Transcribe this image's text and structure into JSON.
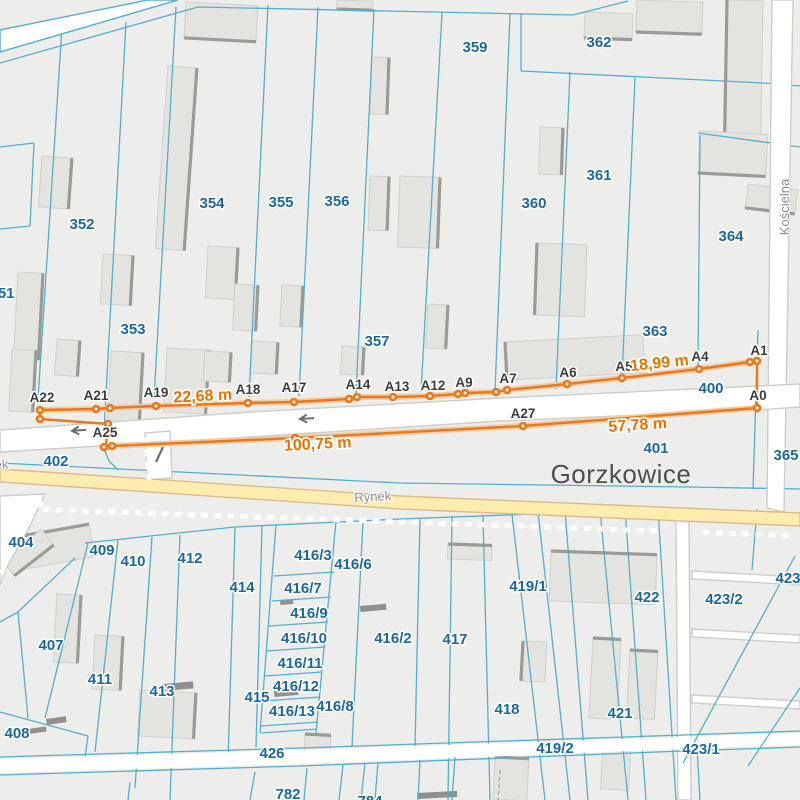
{
  "map": {
    "title": "Cadastral map with survey measurement line, Gorzkowice",
    "town_label": {
      "text": "Gorzkowice",
      "x": 621,
      "y": 483
    },
    "street_labels": [
      {
        "text": "Rynek",
        "x": 373,
        "y": 501,
        "rot": -3,
        "anchor": "middle"
      },
      {
        "text": "Rynek",
        "x": -28,
        "y": 471,
        "rot": -4,
        "anchor": "start"
      },
      {
        "text": "Kościelna",
        "x": 789,
        "y": 207,
        "rot": -90,
        "anchor": "middle"
      }
    ],
    "colors": {
      "land": "#ededeb",
      "parcelLine": "#54aecd",
      "parcelLabel": "#1b679f",
      "building": "#e3e3e0",
      "buildingStroke": "#cfcfcc",
      "buildingShadow": "#9a9a97",
      "road": "#ffffff",
      "roadCasing": "#cdcdca",
      "yellowRoad": "#fcecae",
      "yellowCasing": "#dfba8e",
      "survey": "#e8791d",
      "surveyHalo": "#f0cda6",
      "distance": "#e87200",
      "pointLabel": "#3c3c3c",
      "town": "#4f4f4f",
      "street": "#8e8e8e",
      "arrow": "#6e6e6e",
      "dash": "#ffffff",
      "bar": "#8f8f8c"
    },
    "survey": {
      "points": [
        {
          "id": "A22",
          "x": 40,
          "y": 410,
          "label_x": 42,
          "label_y": 402
        },
        {
          "id": "A21",
          "x": 96,
          "y": 409,
          "label_x": 96,
          "label_y": 400
        },
        {
          "id": "A19",
          "x": 156,
          "y": 406,
          "label_x": 156,
          "label_y": 397
        },
        {
          "id": "A18",
          "x": 248,
          "y": 403,
          "label_x": 248,
          "label_y": 394
        },
        {
          "id": "A17",
          "x": 294,
          "y": 402,
          "label_x": 294,
          "label_y": 392
        },
        {
          "id": "A14",
          "x": 349,
          "y": 399,
          "label_x": 358,
          "label_y": 389
        },
        {
          "id": "A13",
          "x": 393,
          "y": 397,
          "label_x": 397,
          "label_y": 391
        },
        {
          "id": "A12",
          "x": 430,
          "y": 396,
          "label_x": 433,
          "label_y": 390
        },
        {
          "id": "A9",
          "x": 458,
          "y": 394,
          "label_x": 464,
          "label_y": 387
        },
        {
          "id": "A7",
          "x": 496,
          "y": 392,
          "label_x": 508,
          "label_y": 383
        },
        {
          "id": "A6",
          "x": 567,
          "y": 384,
          "label_x": 568,
          "label_y": 377
        },
        {
          "id": "A5",
          "x": 622,
          "y": 378,
          "label_x": 624,
          "label_y": 371
        },
        {
          "id": "A4",
          "x": 699,
          "y": 369,
          "label_x": 700,
          "label_y": 361
        },
        {
          "id": "A1",
          "x": 757,
          "y": 361,
          "label_x": 759,
          "label_y": 355
        },
        {
          "id": "A0",
          "x": 757,
          "y": 408,
          "label_x": 758,
          "label_y": 400
        },
        {
          "id": "A27",
          "x": 523,
          "y": 426,
          "label_x": 523,
          "label_y": 418
        },
        {
          "id": "A25",
          "x": 108,
          "y": 424,
          "label_x": 105,
          "label_y": 437
        }
      ],
      "extra_points": [
        [
          40,
          419
        ],
        [
          110,
          408
        ],
        [
          357,
          397
        ],
        [
          465,
          393
        ],
        [
          507,
          390
        ],
        [
          750,
          362
        ],
        [
          104,
          447
        ],
        [
          112,
          446
        ],
        [
          295,
          438
        ]
      ],
      "polylines": {
        "upper": "40,410 96,409 110,408 156,406 248,403 294,402 349,399 357,397 393,397 430,396 458,394 465,393 496,392 507,390 567,384 622,378 699,369 750,362 757,361",
        "a22_tie": "40,410 40,419",
        "a25_link": "40,419 108,424 106,445",
        "lower": "104,447 112,446 295,438 523,426 757,408",
        "a1_a0": "757,361 757,408"
      },
      "distance_labels": [
        {
          "text": "22,68 m",
          "x": 203,
          "y": 401,
          "rot": -3
        },
        {
          "text": "18,99 m",
          "x": 660,
          "y": 368,
          "rot": -6
        },
        {
          "text": "100,75 m",
          "x": 318,
          "y": 449,
          "rot": -3
        },
        {
          "text": "57,78 m",
          "x": 638,
          "y": 430,
          "rot": -4
        }
      ]
    },
    "parcel_labels": [
      {
        "text": "359",
        "x": 475,
        "y": 52
      },
      {
        "text": "362",
        "x": 599,
        "y": 47
      },
      {
        "text": "361",
        "x": 599,
        "y": 180
      },
      {
        "text": "360",
        "x": 534,
        "y": 208
      },
      {
        "text": "364",
        "x": 731,
        "y": 241
      },
      {
        "text": "354",
        "x": 212,
        "y": 208
      },
      {
        "text": "355",
        "x": 281,
        "y": 207
      },
      {
        "text": "356",
        "x": 337,
        "y": 206
      },
      {
        "text": "352",
        "x": 82,
        "y": 229
      },
      {
        "text": "353",
        "x": 133,
        "y": 334
      },
      {
        "text": "351",
        "x": 2,
        "y": 298
      },
      {
        "text": "357",
        "x": 377,
        "y": 346
      },
      {
        "text": "363",
        "x": 655,
        "y": 336
      },
      {
        "text": "400",
        "x": 711,
        "y": 393
      },
      {
        "text": "401",
        "x": 656,
        "y": 453
      },
      {
        "text": "402",
        "x": 56,
        "y": 466
      },
      {
        "text": "365",
        "x": 786,
        "y": 460
      },
      {
        "text": "404",
        "x": 21,
        "y": 547
      },
      {
        "text": "409",
        "x": 102,
        "y": 555
      },
      {
        "text": "410",
        "x": 133,
        "y": 566
      },
      {
        "text": "412",
        "x": 190,
        "y": 563
      },
      {
        "text": "414",
        "x": 242,
        "y": 592
      },
      {
        "text": "416/3",
        "x": 313,
        "y": 560
      },
      {
        "text": "416/6",
        "x": 353,
        "y": 569
      },
      {
        "text": "416/7",
        "x": 303,
        "y": 593
      },
      {
        "text": "416/9",
        "x": 309,
        "y": 618
      },
      {
        "text": "416/10",
        "x": 304,
        "y": 643
      },
      {
        "text": "416/11",
        "x": 300,
        "y": 668
      },
      {
        "text": "416/12",
        "x": 296,
        "y": 691
      },
      {
        "text": "416/13",
        "x": 292,
        "y": 716
      },
      {
        "text": "416/8",
        "x": 335,
        "y": 711
      },
      {
        "text": "416/2",
        "x": 393,
        "y": 643
      },
      {
        "text": "417",
        "x": 455,
        "y": 644
      },
      {
        "text": "419/1",
        "x": 528,
        "y": 591
      },
      {
        "text": "422",
        "x": 647,
        "y": 602
      },
      {
        "text": "423/2",
        "x": 724,
        "y": 604
      },
      {
        "text": "423",
        "x": 788,
        "y": 583
      },
      {
        "text": "421",
        "x": 620,
        "y": 718
      },
      {
        "text": "418",
        "x": 507,
        "y": 714
      },
      {
        "text": "419/2",
        "x": 555,
        "y": 753
      },
      {
        "text": "423/1",
        "x": 701,
        "y": 754
      },
      {
        "text": "407",
        "x": 51,
        "y": 650
      },
      {
        "text": "411",
        "x": 100,
        "y": 684
      },
      {
        "text": "413",
        "x": 162,
        "y": 696
      },
      {
        "text": "415",
        "x": 257,
        "y": 702
      },
      {
        "text": "408",
        "x": 17,
        "y": 738
      },
      {
        "text": "426",
        "x": 272,
        "y": 758
      },
      {
        "text": "782",
        "x": 288,
        "y": 799
      },
      {
        "text": "784",
        "x": 370,
        "y": 806
      }
    ],
    "geometry": {
      "parcel_lines": [
        "0,63 198,7",
        "198,7 573,15",
        "573,15 628,1",
        "521,14 521,71",
        "521,71 763,83 800,86",
        "698,133 800,147",
        "0,147 34,143",
        "34,143 30,226",
        "0,229 30,226",
        "62,27 38,399",
        "126,22 104,431",
        "176,7 154,399",
        "268,5 249,397",
        "318,7 299,396",
        "374,9 356,394",
        "442,13 421,392",
        "510,14 495,391",
        "570,72 556,389",
        "635,78 622,378",
        "700,135 698,368",
        "0,463 400,483 690,487 800,489",
        "85,543 235,527 400,519 560,513 683,508",
        "88,543 45,718",
        "75,558 18,612 0,622",
        "18,612 28,718",
        "118,540 95,752",
        "152,537 135,788",
        "180,535 170,800",
        "235,528 228,762",
        "262,526 256,747",
        "276,525 260,733",
        "336,521 316,733",
        "274,576 334,572",
        "272,601 331,597",
        "269,626 328,622",
        "267,651 325,647",
        "265,676 322,672",
        "263,701 320,697",
        "261,726 318,722",
        "261,733 317,729",
        "363,520 352,747",
        "420,518 415,747",
        "452,516 448,800",
        "483,515 490,800",
        "512,514 545,800",
        "538,512 570,800",
        "565,511 588,800",
        "600,510 628,800",
        "625,509 646,800",
        "658,509 676,800",
        "757,509 752,570",
        "0,712 88,736",
        "88,736 85,757"
      ],
      "parcel_lines_over": [
        "758,330 753,489",
        "104,449 109,461 118,470",
        "0,757 300,748 683,735 800,731",
        "0,775 300,766 683,751 800,747",
        "795,556 683,763",
        "800,688 748,766",
        "255,772 250,800",
        "307,768 304,800",
        "343,765 339,800",
        "365,763 361,800",
        "378,762 375,800",
        "420,760 418,800",
        "455,757 452,800",
        "130,782 128,800",
        "697,748 700,800"
      ],
      "roads": [
        {
          "name": "road-topleft-diagonal",
          "pts": "0,30 148,0 178,0 0,52",
          "fill": "road",
          "stroke": "parcelLine"
        },
        {
          "name": "road-koscielna",
          "pts": "772,0 793,0 784,512 767,508",
          "fill": "road",
          "stroke": "roadCasing"
        },
        {
          "name": "road-mid-street",
          "pts": "0,430 250,412 500,398 757,386 800,384 800,407 757,410 500,421 250,437 0,452",
          "fill": "road",
          "stroke": "roadCasing"
        },
        {
          "name": "road-connector-west",
          "pts": "145,433 170,431 172,478 147,480",
          "fill": "road",
          "stroke": "roadCasing"
        },
        {
          "name": "road-left-curve",
          "pts": "0,496 45,494 28,530 8,565 0,585",
          "fill": "road",
          "stroke": "roadCasing"
        },
        {
          "name": "road-rynek",
          "pts": "0,469 120,477 400,496 683,508 800,513 800,526 683,521 400,509 120,490 0,482",
          "fill": "yellowRoad",
          "stroke": "yellowCasing"
        },
        {
          "name": "road-connector-south",
          "pts": "676,521 689,522 691,800 678,800",
          "fill": "road",
          "stroke": "roadCasing"
        },
        {
          "name": "road-bottom-426",
          "pts": "0,759 300,750 683,737 800,733 800,745 683,749 300,764 0,773",
          "fill": "road",
          "stroke": "none"
        },
        {
          "name": "track-east-1",
          "pts": "692,571 800,577 800,585 692,579",
          "fill": "road",
          "stroke": "roadCasing"
        },
        {
          "name": "track-east-2",
          "pts": "692,629 800,635 800,643 692,637",
          "fill": "road",
          "stroke": "roadCasing"
        },
        {
          "name": "track-east-3",
          "pts": "692,695 800,701 800,709 692,703",
          "fill": "road",
          "stroke": "roadCasing"
        }
      ],
      "buildings": [
        [
          186,
          2,
          72,
          36,
          3,
          "b"
        ],
        [
          337,
          0,
          36,
          9,
          2,
          "b"
        ],
        [
          585,
          12,
          48,
          26,
          2,
          "b"
        ],
        [
          637,
          0,
          66,
          32,
          2,
          "b"
        ],
        [
          727,
          0,
          36,
          135,
          1,
          "l"
        ],
        [
          700,
          131,
          68,
          42,
          3,
          "b"
        ],
        [
          748,
          184,
          50,
          24,
          7,
          "b"
        ],
        [
          540,
          127,
          23,
          47,
          2,
          "r"
        ],
        [
          400,
          176,
          40,
          71,
          2,
          "r"
        ],
        [
          428,
          304,
          20,
          44,
          3,
          "r"
        ],
        [
          168,
          66,
          29,
          183,
          4,
          "r"
        ],
        [
          42,
          156,
          30,
          51,
          4,
          "r"
        ],
        [
          18,
          272,
          25,
          87,
          3,
          "r"
        ],
        [
          103,
          254,
          30,
          50,
          3,
          "r"
        ],
        [
          208,
          246,
          30,
          52,
          3,
          "r"
        ],
        [
          235,
          284,
          23,
          46,
          3,
          "r"
        ],
        [
          282,
          285,
          21,
          41,
          3,
          "r"
        ],
        [
          370,
          176,
          19,
          54,
          2,
          "r"
        ],
        [
          372,
          57,
          17,
          57,
          2,
          "r"
        ],
        [
          12,
          349,
          24,
          62,
          3,
          "r"
        ],
        [
          57,
          339,
          23,
          36,
          4,
          "r"
        ],
        [
          111,
          351,
          32,
          74,
          3,
          "r"
        ],
        [
          167,
          348,
          42,
          64,
          3,
          "r"
        ],
        [
          205,
          351,
          26,
          30,
          3,
          "r"
        ],
        [
          252,
          341,
          26,
          32,
          3,
          "r"
        ],
        [
          342,
          346,
          22,
          28,
          3,
          "r"
        ],
        [
          537,
          243,
          50,
          72,
          2,
          "l"
        ],
        [
          505,
          342,
          138,
          38,
          -3,
          "l"
        ],
        [
          22,
          536,
          68,
          33,
          -10,
          "t"
        ],
        [
          448,
          544,
          44,
          15,
          2,
          "t"
        ],
        [
          551,
          551,
          106,
          50,
          2,
          "t"
        ],
        [
          523,
          641,
          24,
          40,
          3,
          "l"
        ],
        [
          593,
          638,
          28,
          80,
          3,
          "t"
        ],
        [
          630,
          650,
          28,
          68,
          3,
          "t"
        ],
        [
          603,
          743,
          28,
          46,
          3,
          "t"
        ],
        [
          495,
          757,
          34,
          42,
          3,
          "t"
        ],
        [
          57,
          594,
          24,
          68,
          3,
          "r"
        ],
        [
          95,
          635,
          28,
          54,
          3,
          "r"
        ],
        [
          140,
          690,
          56,
          46,
          3,
          "r"
        ],
        [
          2,
          560,
          50,
          20,
          -38,
          "b"
        ],
        [
          305,
          734,
          26,
          26,
          3,
          "t"
        ]
      ],
      "bars": [
        [
          28,
          729,
          18,
          5,
          -8
        ],
        [
          46,
          719,
          20,
          6,
          -8
        ],
        [
          280,
          600,
          13,
          5,
          -5
        ],
        [
          360,
          606,
          26,
          6,
          -5
        ],
        [
          274,
          691,
          24,
          6,
          -5
        ],
        [
          163,
          684,
          30,
          7,
          -5
        ],
        [
          417,
          793,
          40,
          6,
          -3
        ]
      ],
      "dash_row": {
        "x_start": 46,
        "x_end": 794,
        "step": 13.2,
        "gap_from": 666,
        "gap_to": 700,
        "y_base": 508,
        "slope": 0.035,
        "w": 7,
        "h": 5,
        "rot": -3
      },
      "dash_column": [
        [
          146,
          441
        ],
        [
          147,
          453
        ],
        [
          148,
          465
        ],
        [
          149,
          477
        ]
      ],
      "dash_curve": [
        [
          40,
          504,
          -35
        ],
        [
          30,
          517,
          -45
        ],
        [
          21,
          530,
          -55
        ],
        [
          13,
          543,
          -60
        ],
        [
          7,
          556,
          -65
        ],
        [
          3,
          570,
          -68
        ]
      ],
      "dashed_gray_line": "500,770 498,800",
      "arrows": [
        {
          "x": 70,
          "y": 431,
          "rot": -4
        },
        {
          "x": 298,
          "y": 419,
          "rot": -3
        }
      ],
      "slash_mark": {
        "x1": 156,
        "y1": 462,
        "x2": 163,
        "y2": 447
      }
    }
  }
}
